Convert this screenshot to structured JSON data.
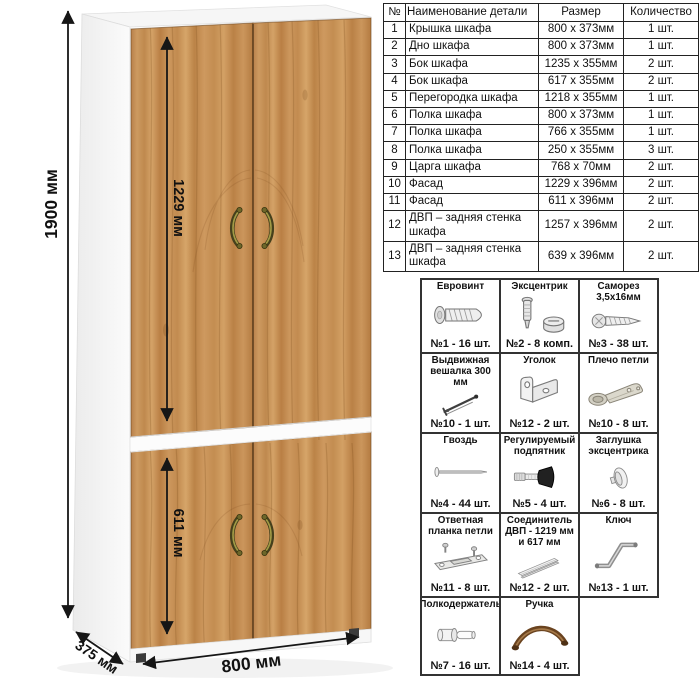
{
  "wardrobe": {
    "dimensions": {
      "height": "1900 мм",
      "upper_facade_height": "1229 мм",
      "lower_facade_height": "611 мм",
      "width": "800 мм",
      "depth": "375 мм"
    },
    "colors": {
      "wood": "#c48f57",
      "handle_bronze": "#8a8136",
      "panel_white": "#fafafa",
      "line_black": "#161616"
    }
  },
  "parts_table": {
    "headers": {
      "num": "№",
      "name": "Наименование детали",
      "size": "Размер",
      "qty": "Количество"
    },
    "rows": [
      {
        "num": "1",
        "name": "Крышка шкафа",
        "size": "800 x 373мм",
        "qty": "1 шт."
      },
      {
        "num": "2",
        "name": "Дно шкафа",
        "size": "800 x 373мм",
        "qty": "1 шт."
      },
      {
        "num": "3",
        "name": "Бок шкафа",
        "size": "1235 x 355мм",
        "qty": "2 шт."
      },
      {
        "num": "4",
        "name": "Бок шкафа",
        "size": "617 x 355мм",
        "qty": "2 шт."
      },
      {
        "num": "5",
        "name": "Перегородка шкафа",
        "size": "1218 x 355мм",
        "qty": "1 шт."
      },
      {
        "num": "6",
        "name": "Полка шкафа",
        "size": "800 x 373мм",
        "qty": "1 шт."
      },
      {
        "num": "7",
        "name": "Полка шкафа",
        "size": "766 x 355мм",
        "qty": "1 шт."
      },
      {
        "num": "8",
        "name": "Полка шкафа",
        "size": "250 x 355мм",
        "qty": "3 шт."
      },
      {
        "num": "9",
        "name": "Царга шкафа",
        "size": "768 x 70мм",
        "qty": "2 шт."
      },
      {
        "num": "10",
        "name": "Фасад",
        "size": "1229 x 396мм",
        "qty": "2 шт."
      },
      {
        "num": "11",
        "name": "Фасад",
        "size": "611 x 396мм",
        "qty": "2 шт."
      },
      {
        "num": "12",
        "name": "ДВП – задняя стенка шкафа",
        "size": "1257 x 396мм",
        "qty": "2 шт."
      },
      {
        "num": "13",
        "name": "ДВП – задняя стенка шкафа",
        "size": "639 x 396мм",
        "qty": "2 шт."
      }
    ]
  },
  "hardware": {
    "items": [
      {
        "title": "Евровинт",
        "label": "№1 - 16 шт.",
        "icon": "euro-screw-icon"
      },
      {
        "title": "Эксцентрик",
        "label": "№2 - 8 комп.",
        "icon": "eccentric-cam-icon"
      },
      {
        "title": "Саморез 3,5x16мм",
        "label": "№3 - 38 шт.",
        "icon": "tapping-screw-icon"
      },
      {
        "title": "Выдвижная вешалка 300 мм",
        "label": "№10 - 1 шт.",
        "icon": "pullout-hanger-icon"
      },
      {
        "title": "Уголок",
        "label": "№12 - 2 шт.",
        "icon": "corner-bracket-icon"
      },
      {
        "title": "Плечо петли",
        "label": "№10 - 8 шт.",
        "icon": "hinge-arm-icon"
      },
      {
        "title": "Гвоздь",
        "label": "№4 - 44 шт.",
        "icon": "nail-icon"
      },
      {
        "title": "Регулируемый подпятник",
        "label": "№5 - 4 шт.",
        "icon": "adjustable-foot-icon"
      },
      {
        "title": "Заглушка эксцентрика",
        "label": "№6 - 8 шт.",
        "icon": "cam-cap-icon"
      },
      {
        "title": "Ответная планка петли",
        "label": "№11 - 8 шт.",
        "icon": "hinge-plate-icon"
      },
      {
        "title": "Соединитель ДВП - 1219 мм и 617 мм",
        "label": "№12 - 2 шт.",
        "icon": "hdf-connector-icon"
      },
      {
        "title": "Ключ",
        "label": "№13 - 1 шт.",
        "icon": "hex-key-icon"
      },
      {
        "title": "Полкодержатель",
        "label": "№7 - 16 шт.",
        "icon": "shelf-pin-icon"
      },
      {
        "title": "Ручка",
        "label": "№14 - 4 шт.",
        "icon": "handle-icon"
      }
    ]
  }
}
